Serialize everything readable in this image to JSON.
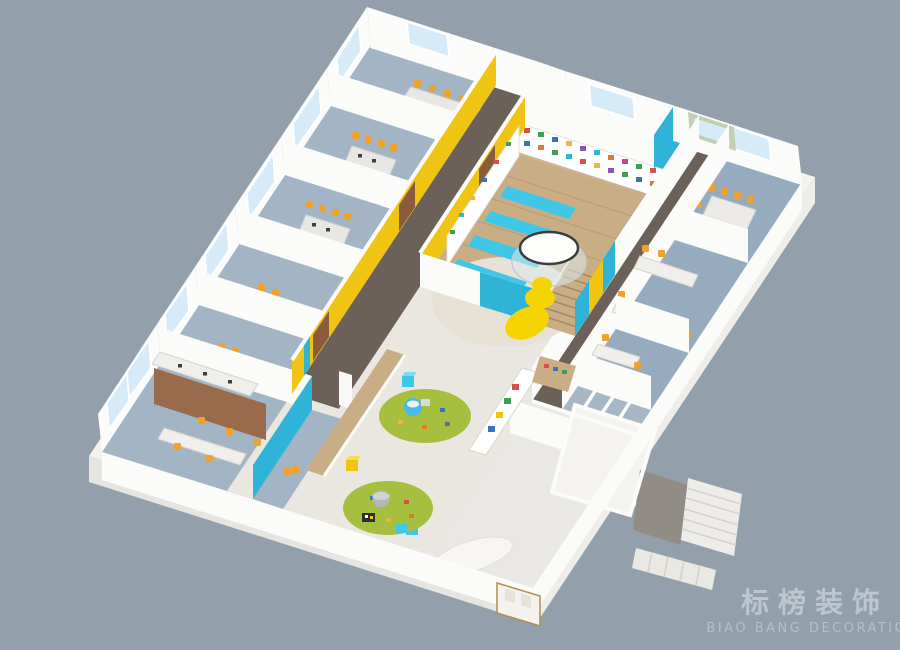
{
  "watermark": {
    "title": "标榜装饰",
    "subtitle": "BIAO BANG DECORATION"
  },
  "palette": {
    "background": "#93a0ab",
    "plinth": "#f3f2ee",
    "plinth_shade": "#e7e5e1",
    "floor_base": "#eceae5",
    "wall_white": "#fbfbf9",
    "carpet_blue": "#a3b5c5",
    "carpet_office": "#96abbe",
    "carpet_light": "#a6b6c2",
    "corridor_dark": "#6b6159",
    "wood": "#c9ad85",
    "wood_line": "#b3946a",
    "play_floor": "#eae7e0",
    "accent_yellow": "#f0c413",
    "accent_cyan": "#2fb3d6",
    "mat_cyan": "#3fc7e7",
    "slide_yellow": "#f4d503",
    "rug_green": "#a7bf3f",
    "chair_orange": "#efa22b",
    "partition_brown": "#9a6b4a",
    "door_brown": "#8a5c3c",
    "window_blue": "#d6ebf7",
    "stair_light": "#edece8",
    "watermark_color": "#c9d3da"
  },
  "scene": {
    "style": "isometric-3d-floorplan-render",
    "areas": [
      "classrooms-row",
      "yellow-corridor",
      "library-reading-room",
      "kids-play-area",
      "open-office",
      "meeting-room",
      "offices",
      "restrooms",
      "reception",
      "stair-core",
      "entrance"
    ],
    "features": [
      "glass-dome-with-slide",
      "bookshelf-wall",
      "reading-mats",
      "round-play-rugs",
      "cube-stools",
      "photo-display-wall",
      "staircase",
      "exterior-windows"
    ]
  }
}
